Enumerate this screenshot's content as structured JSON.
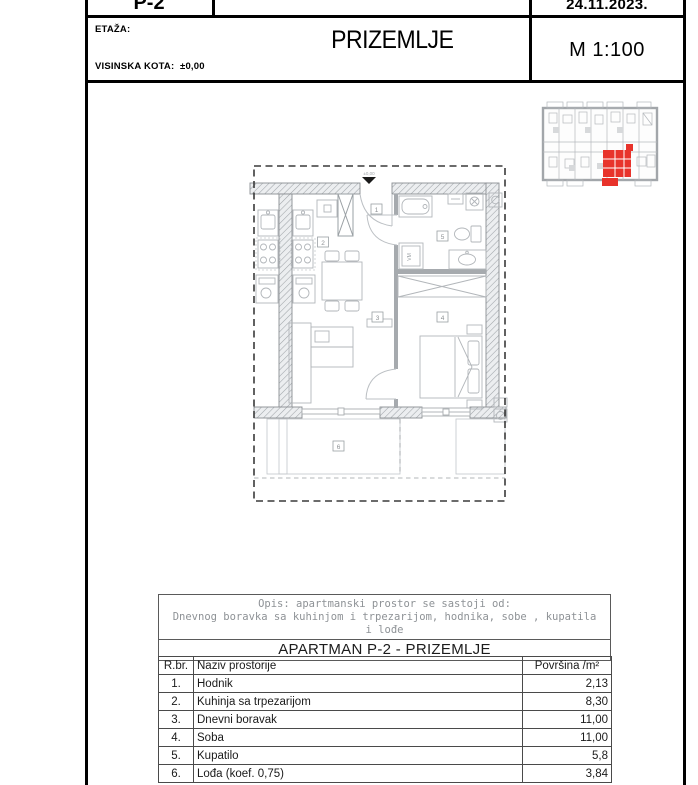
{
  "header": {
    "code": "P-2",
    "date": "24.11.2023.",
    "etaza_label": "ETAŽA:",
    "visinska_label": "VISINSKA KOTA:",
    "visinska_value": "±0,00",
    "floor_title": "PRIZEMLJE",
    "scale": "M 1:100"
  },
  "plan": {
    "rooms": [
      "1",
      "2",
      "3",
      "4",
      "5",
      "6"
    ],
    "vm_label": "VM",
    "entry_elevation": "±0,00"
  },
  "description": {
    "line1": "Opis:  apartmanski prostor se sastoji od:",
    "line2": "Dnevnog boravka sa kuhinjom i trpezarijom, hodnika, sobe , kupatila",
    "line3": "i lođe"
  },
  "apartment_table": {
    "title": "APARTMAN P-2 - PRIZEMLJE",
    "columns": [
      "R.br.",
      "Naziv prostorije",
      "Površina /m²"
    ],
    "rows": [
      {
        "num": "1.",
        "name": "Hodnik",
        "area": "2,13"
      },
      {
        "num": "2.",
        "name": "Kuhinja sa trpezarijom",
        "area": "8,30"
      },
      {
        "num": "3.",
        "name": "Dnevni boravak",
        "area": "11,00"
      },
      {
        "num": "4.",
        "name": "Soba",
        "area": "11,00"
      },
      {
        "num": "5.",
        "name": "Kupatilo",
        "area": "5,8"
      },
      {
        "num": "6.",
        "name": "Lođa (koef. 0,75)",
        "area": "3,84"
      }
    ]
  },
  "colors": {
    "highlight_red": "#e8332b",
    "plan_gray": "#9aa0a4",
    "border_black": "#000000"
  }
}
